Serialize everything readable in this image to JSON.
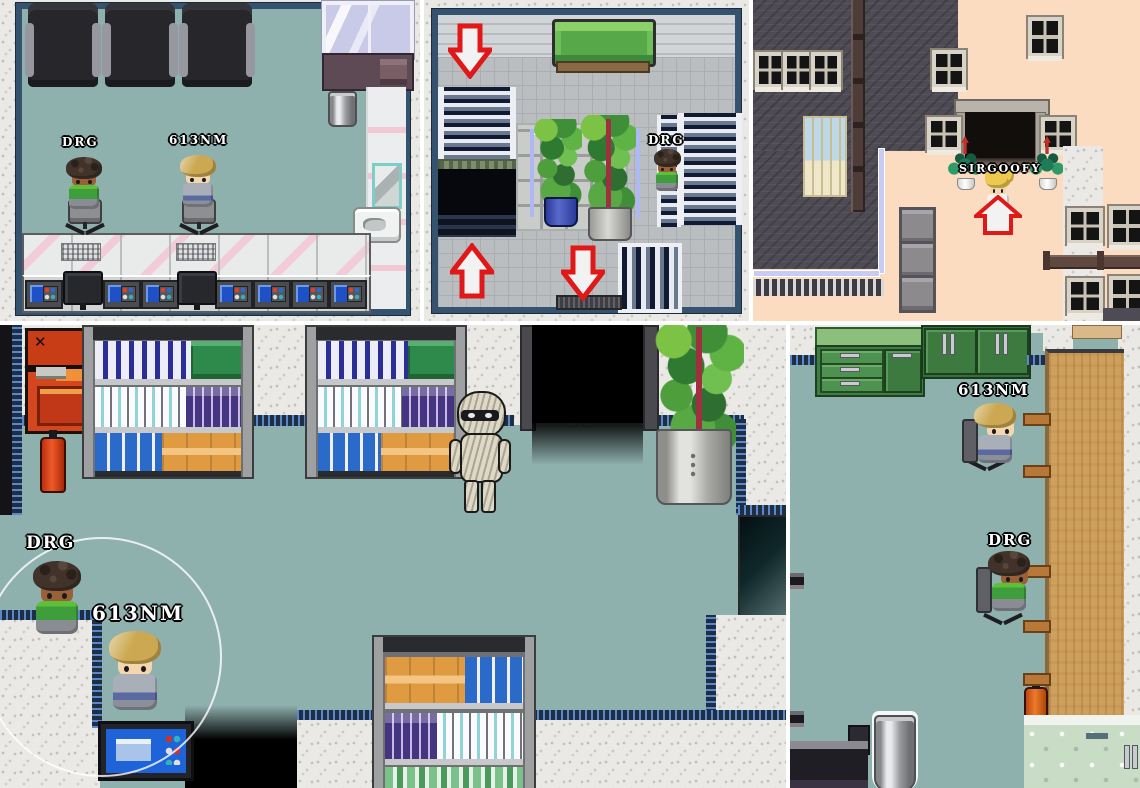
{
  "labels": {
    "drg": "DRG",
    "nm613": "613NM",
    "sirgoofy": "SIRGOOFY"
  },
  "icons": {
    "x_dial": "✕",
    "diamond_dial": "◆"
  },
  "palette": {
    "floor_teal": "#8FB1AE",
    "wall_speckle_gray": "#EBE9E5",
    "map_border_navy": "#35536F",
    "trim_navy": "#1D2F46",
    "trim_dot_blue": "#5D87C6",
    "tile_floor_gray": "#BABEC1",
    "roof_dark_gray": "#4E4B54",
    "building_peach": "#FBDCC1",
    "couch_green": "#57A848",
    "cabinet_green": "#3C7A40",
    "table_wood": "#CDA05E",
    "arrow_outline_red": "#E01818",
    "arrow_fill_white": "#F2F2F2",
    "vending_machine_red": "#D4461E",
    "nameplate_text": "#FFFFFF"
  }
}
